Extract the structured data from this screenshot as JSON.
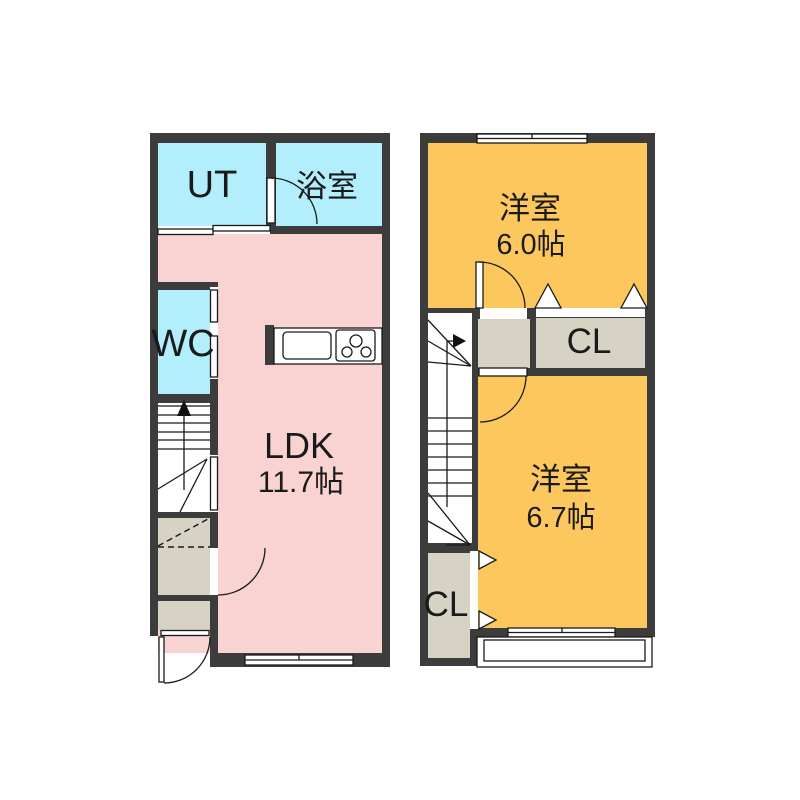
{
  "colors": {
    "wall": "#3c3c3c",
    "water": "#b2eefb",
    "ldk": "#f9d2d2",
    "bedroom": "#fcc75c",
    "closet": "#d6d2c4",
    "background": "#ffffff",
    "line": "#1a1a1a"
  },
  "floor1": {
    "ut_label": "UT",
    "bath_label": "浴室",
    "wc_label": "WC",
    "ldk_label": "LDK",
    "ldk_size": "11.7帖"
  },
  "floor2": {
    "bedroom1_label": "洋室",
    "bedroom1_size": "6.0帖",
    "closet1_label": "CL",
    "bedroom2_label": "洋室",
    "bedroom2_size": "6.7帖",
    "closet2_label": "CL"
  }
}
